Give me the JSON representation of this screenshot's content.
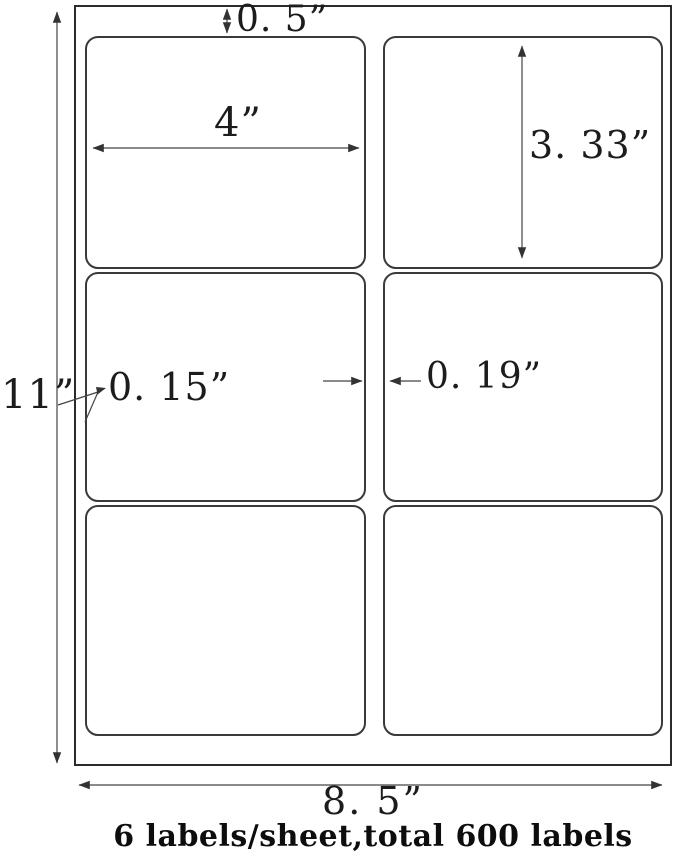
{
  "diagram": {
    "title": "label-sheet-dimension-diagram",
    "dimensions": {
      "sheet_height": "11”",
      "sheet_width": "8. 5”",
      "top_margin": "0. 5”",
      "label_width": "4”",
      "label_height": "3. 33”",
      "side_margin": "0. 15”",
      "column_gap": "0. 19”"
    },
    "caption": "6 labels/sheet,total 600 labels",
    "grid": {
      "rows": 3,
      "columns": 2
    },
    "colors": {
      "sheet_border": "#2b2b2b",
      "label_border": "#3a3a3a",
      "dimension_line": "#444444",
      "text": "#1c1c1c",
      "background": "#ffffff"
    }
  }
}
